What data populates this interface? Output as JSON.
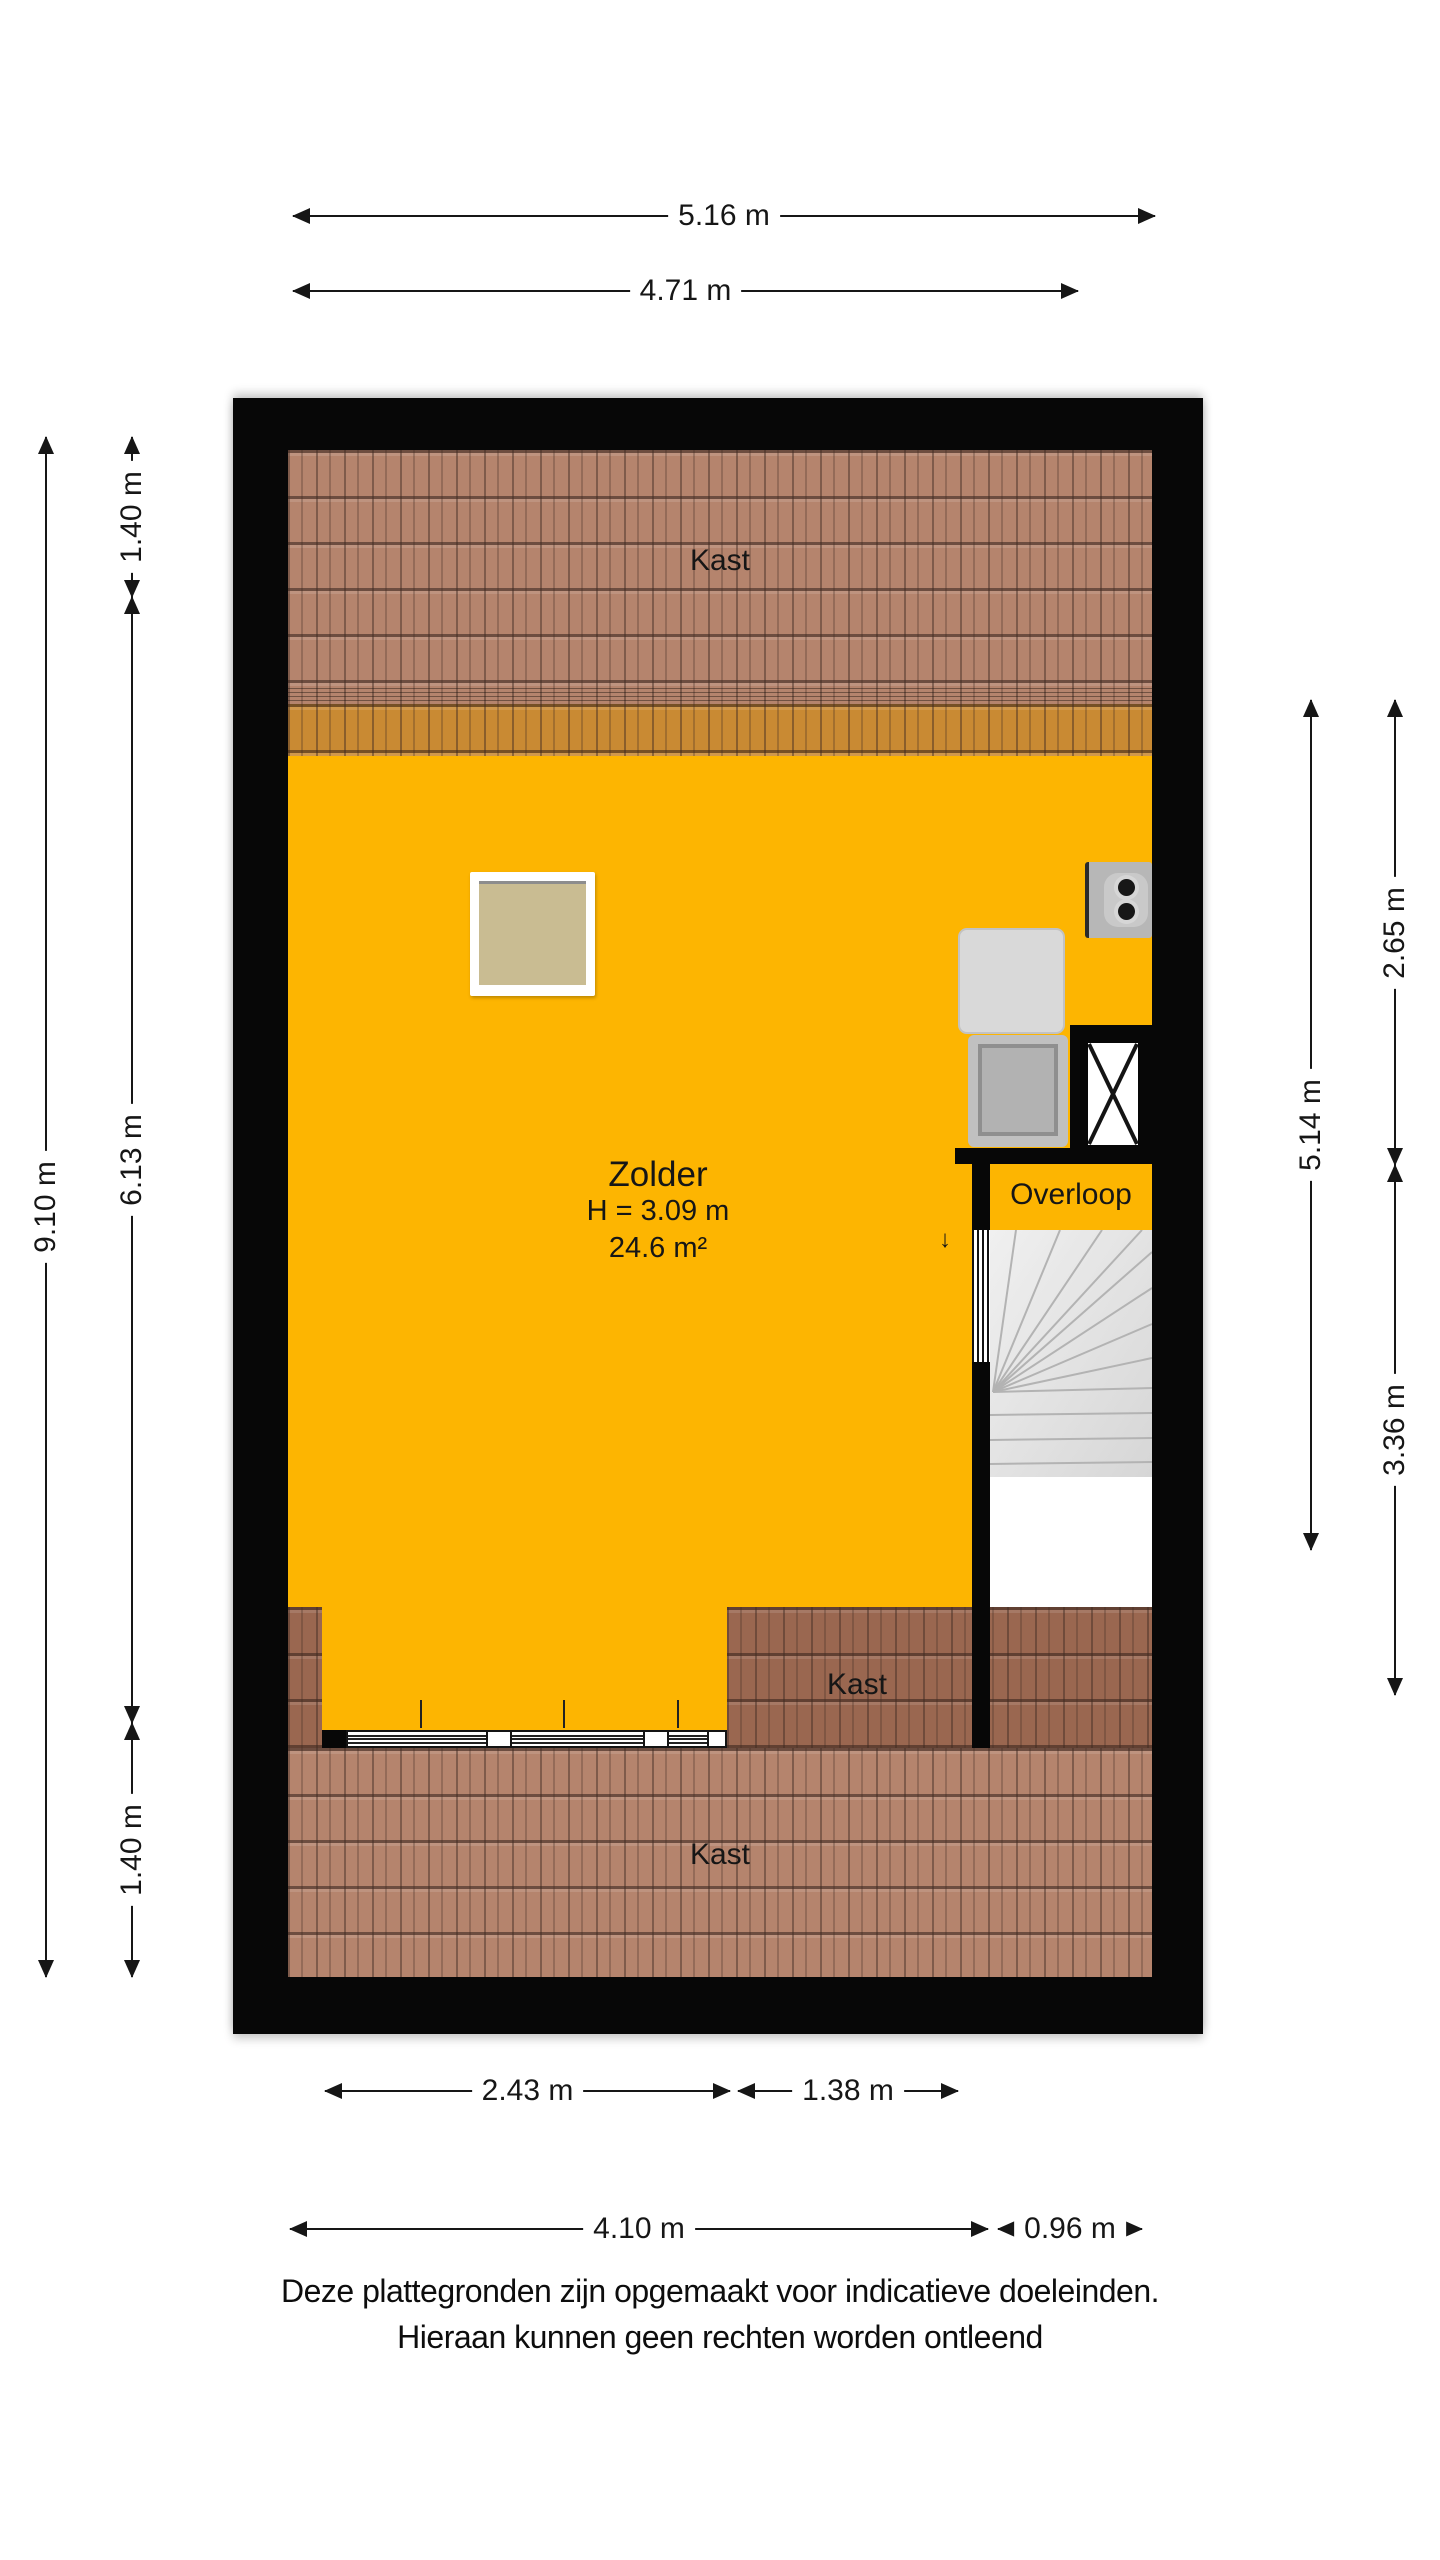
{
  "plan": {
    "rooms": {
      "kast_top": "Kast",
      "zolder_name": "Zolder",
      "zolder_height": "H = 3.09 m",
      "zolder_area": "24.6 m²",
      "overloop": "Overloop",
      "kast_mid": "Kast",
      "kast_bottom": "Kast"
    },
    "stair_direction_arrow": "↓"
  },
  "dimensions": {
    "top_total": "5.16 m",
    "top_inner": "4.71 m",
    "left_total": "9.10 m",
    "left_seg_top": "1.40 m",
    "left_seg_mid": "6.13 m",
    "left_seg_bottom": "1.40 m",
    "right_inner": "5.14 m",
    "right_seg_top": "2.65 m",
    "right_seg_bottom": "3.36 m",
    "bottom_row1_left": "2.43 m",
    "bottom_row1_right": "1.38 m",
    "bottom_row2_left": "4.10 m",
    "bottom_row2_right": "0.96 m"
  },
  "footer": {
    "line1": "Deze plattegronden zijn opgemaakt voor indicatieve doeleinden.",
    "line2": "Hieraan kunnen geen rechten worden ontleend"
  },
  "colors": {
    "floor_yellow": "#FDB501",
    "roof_tile": "#B5846D",
    "roof_tile_dark": "#9A6750",
    "wall_black": "#070707",
    "skylight_tan": "#C9BC92"
  }
}
